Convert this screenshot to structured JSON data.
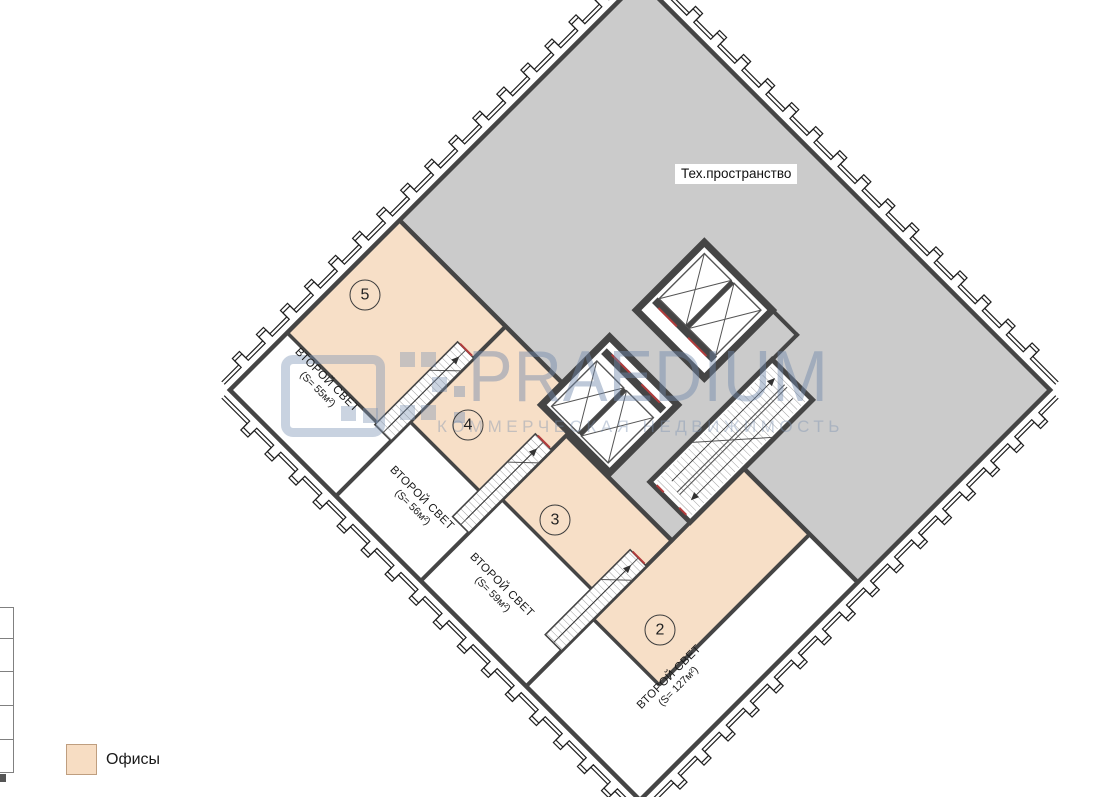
{
  "plan": {
    "tech_space_label": "Тех.пространство",
    "offices": [
      {
        "number": "5"
      },
      {
        "number": "4"
      },
      {
        "number": "3"
      },
      {
        "number": "2"
      }
    ],
    "voids": [
      {
        "line1": "ВТОРОЙ СВЕТ",
        "line2": "(S= 55м²)"
      },
      {
        "line1": "ВТОРОЙ СВЕТ",
        "line2": "(S= 56м²)"
      },
      {
        "line1": "ВТОРОЙ СВЕТ",
        "line2": "(S= 59м²)"
      },
      {
        "line1": "ВТОРОЙ СВЕТ",
        "line2": "(S= 127м²)"
      }
    ],
    "colors": {
      "office_fill": "#f7dfc7",
      "tech_fill": "#cbcbcb",
      "wall": "#454545",
      "accent_red": "#b23b3b"
    }
  },
  "legend": {
    "office_label": "Офисы"
  },
  "watermark": {
    "brand": "PRAEDIUM",
    "subtitle": "КОММЕРЧЕСКАЯ НЕДВИЖИМОСТЬ"
  }
}
